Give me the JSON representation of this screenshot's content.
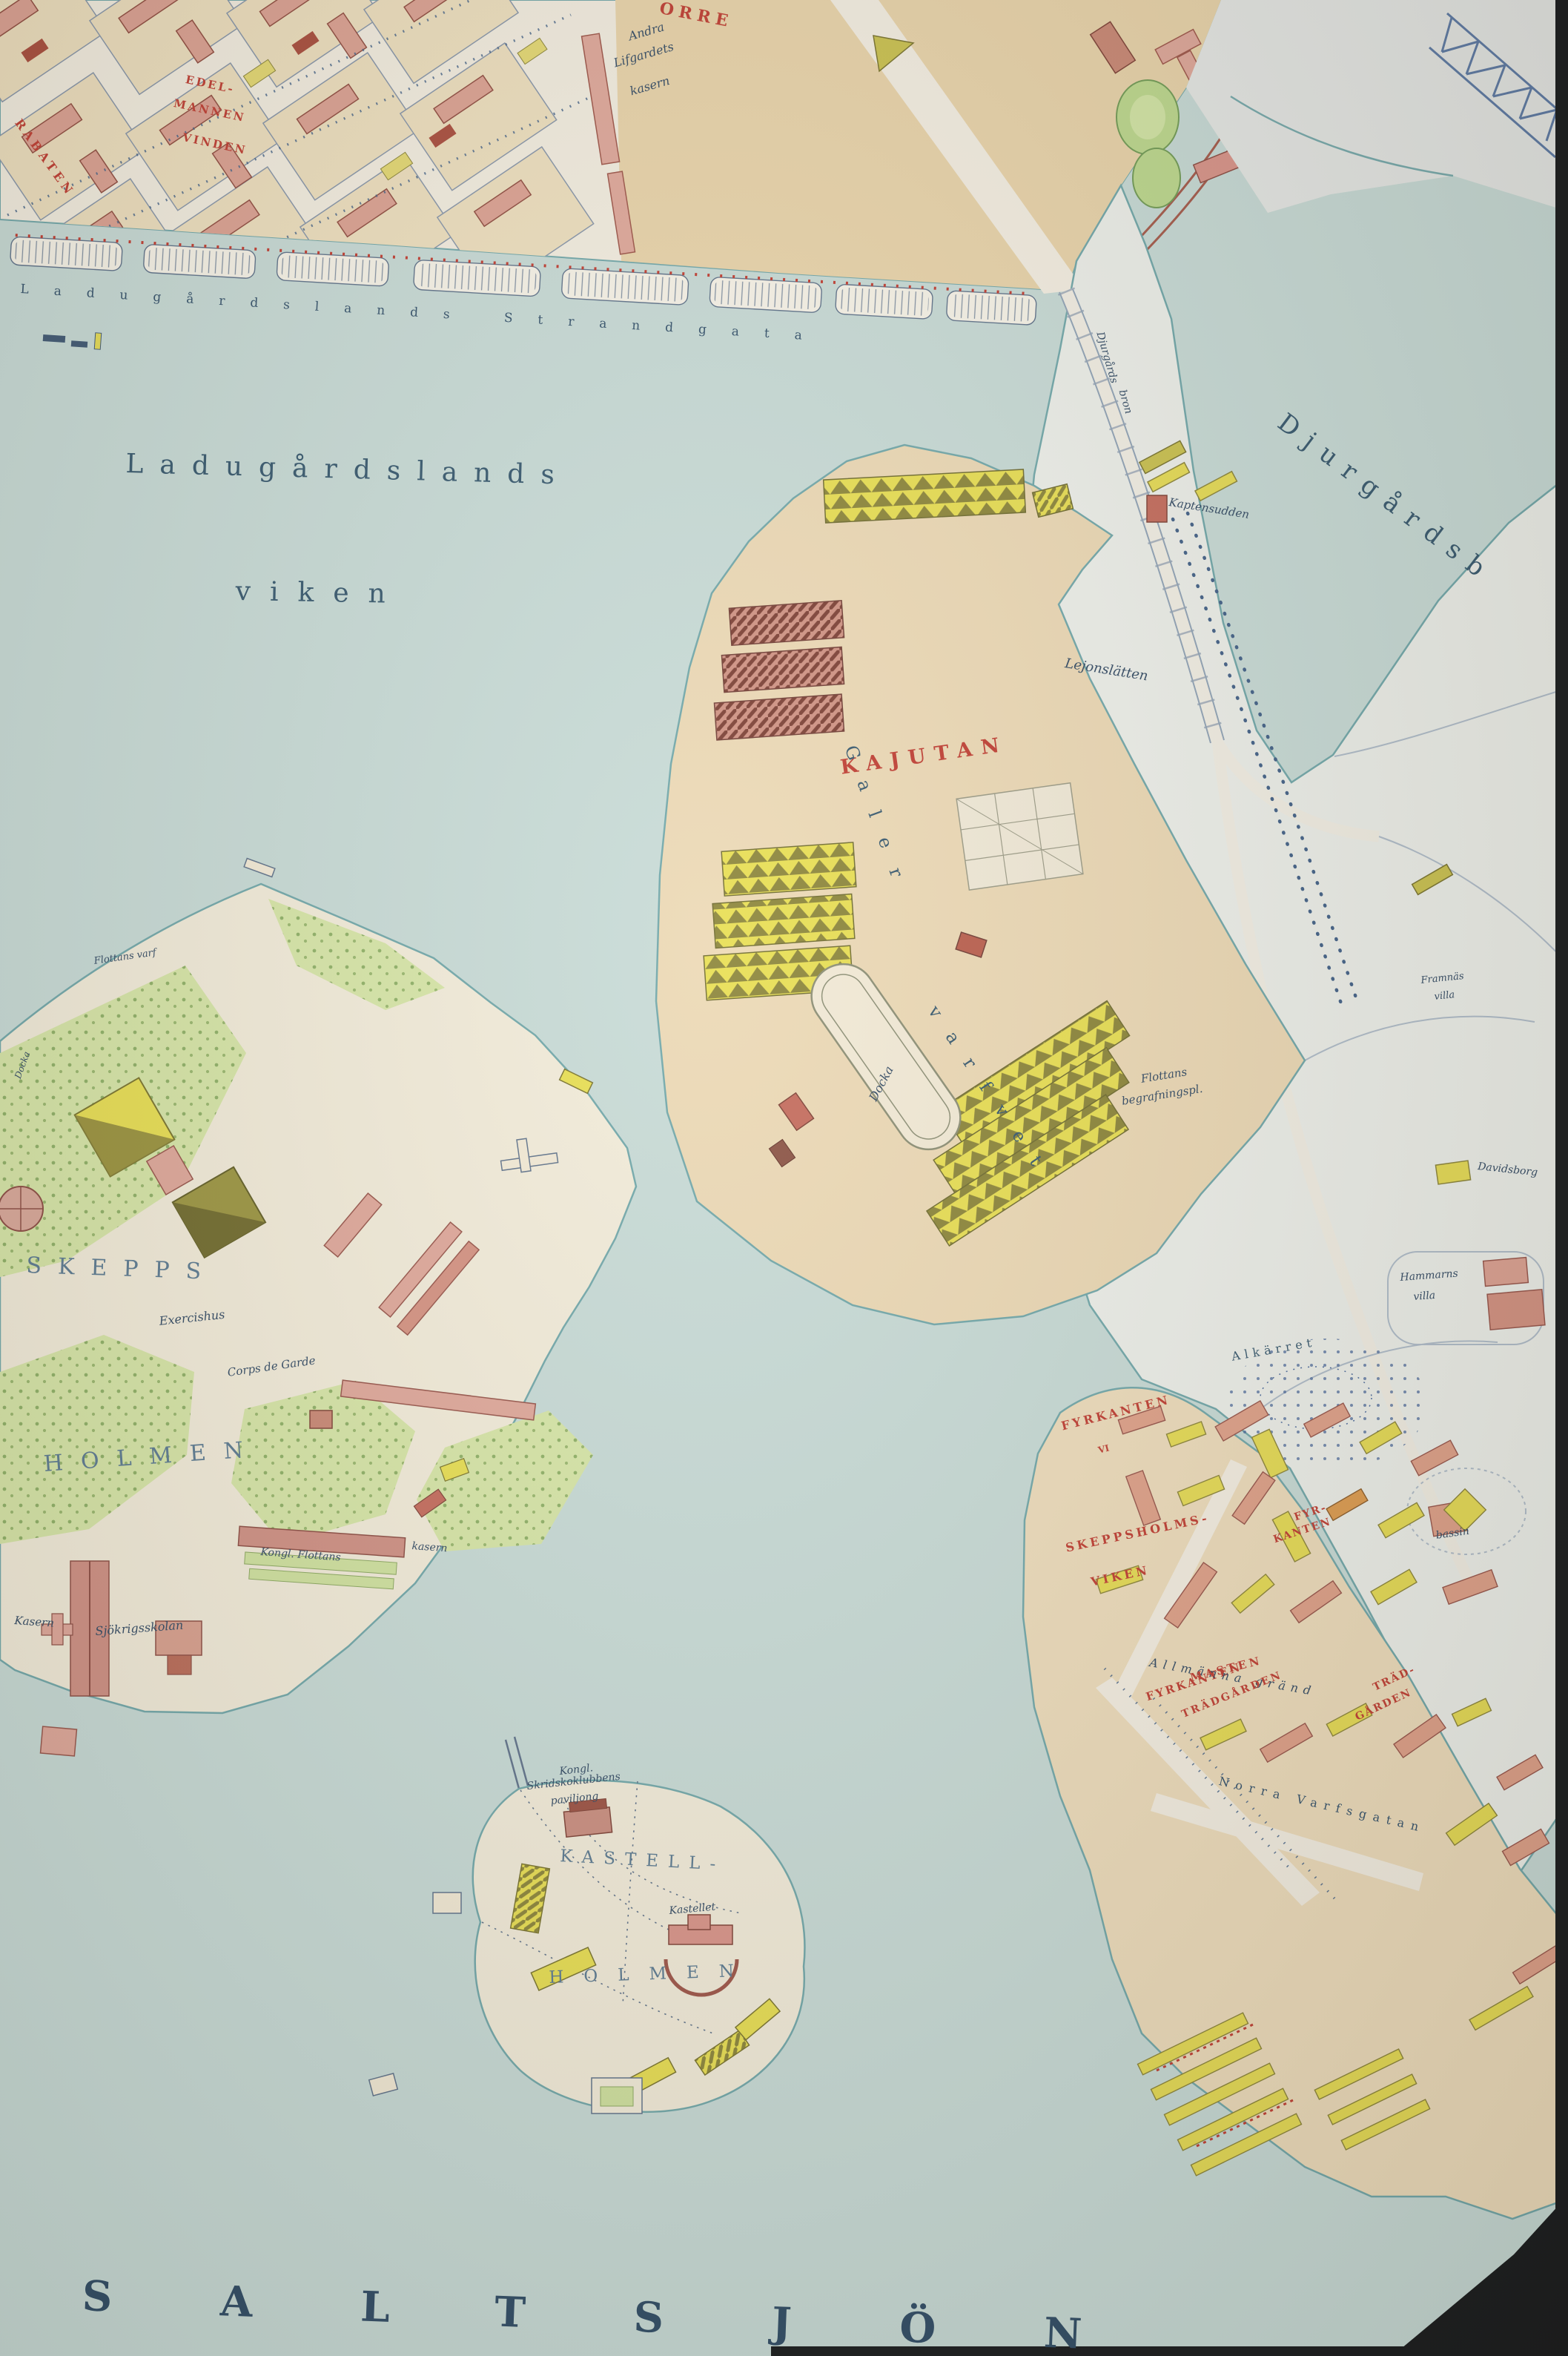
{
  "map_title": "Historical map of Stockholm harbour (Skeppsholmen / Kastellholmen / Djurgården)",
  "water": {
    "bay_nw_line1": "Ladugårdslands",
    "bay_nw_line2": "viken",
    "channel_ne": "Djurgårdsb",
    "sea_south": "SALTSJÖN"
  },
  "streets": {
    "strandgata": "Ladugårdslands Strandgata",
    "allmanna_grand": "Allmänna gränd",
    "norra_varfsgatan": "Norra Varfsgatan",
    "bridge_line1": "Djurgårds",
    "bridge_line2": "bron"
  },
  "districts_red": {
    "kajutan": "KAJUTAN",
    "fyrkanten_nw": "FYRKANTEN",
    "fyrkanten_nw_num": "VI",
    "skeppsholms_line1": "SKEPPSHOLMS-",
    "skeppsholms_line2": "VIKEN",
    "fyrkanten_mid_line1": "FYR-",
    "fyrkanten_mid_line2": "KANTEN",
    "fyrkanten_s": "FYRKANTEN",
    "masten": "MASTEN",
    "tradgarden_w": "TRÄDGÅRDEN",
    "tradgarden_e_line1": "TRÄD-",
    "tradgarden_e_line2": "GÅRDEN",
    "block_rabaten": "RABATEN",
    "block_edel_line1": "EDEL-",
    "block_edel_line2": "MANNEN",
    "block_vinden": "VINDEN",
    "block_orre": "ORRE"
  },
  "islands": {
    "skepps": "SKEPPS",
    "skepps_holmen": "HOLMEN",
    "kastell_line1": "KASTELL-",
    "kastell_line2": "HOLMEN"
  },
  "places": {
    "andra_line1": "Andra",
    "andra_line2": "Lifgardets",
    "andra_line3": "kasern",
    "galer": "Galer",
    "varfvet": "varfvet",
    "docka": "Docka",
    "docka_small": "Docka",
    "flottans_line1": "Flottans",
    "flottans_line2": "begrafningspl.",
    "flottans_varf": "Flottans varf",
    "exercishus": "Exercishus",
    "corps_de_garde": "Corps de Garde",
    "kasern": "Kasern",
    "sjokrigsskolan": "Sjökrigsskolan",
    "kongl_flottans": "Kongl. Flottans",
    "kongl_kasern": "kasern",
    "kastellet": "Kastellet",
    "skridsko_line1": "Kongl.",
    "skridsko_line2": "Skridskoklubbens",
    "skridsko_line3": "paviljong",
    "lejonslatten": "Lejonslätten",
    "kaptensudden": "Kaptensudden",
    "davidsborg": "Davidsborg",
    "framnas_line1": "Framnäs",
    "framnas_line2": "villa",
    "hammarns_line1": "Hammarns",
    "hammarns_line2": "villa",
    "alkarret": "Alkärret",
    "bassin": "bassin"
  },
  "colors": {
    "water": "#c7dbd8",
    "shore": "#6fa7ab",
    "land_tan": "#e9d4ab",
    "land_cream": "#f2ecdb",
    "land_white": "#eef0ed",
    "building_pink": "#dfa089",
    "building_yellow": "#e6dc54",
    "label_red": "#bf3b31",
    "label_navy": "#2f4864",
    "photo_edge": "#15181c"
  }
}
